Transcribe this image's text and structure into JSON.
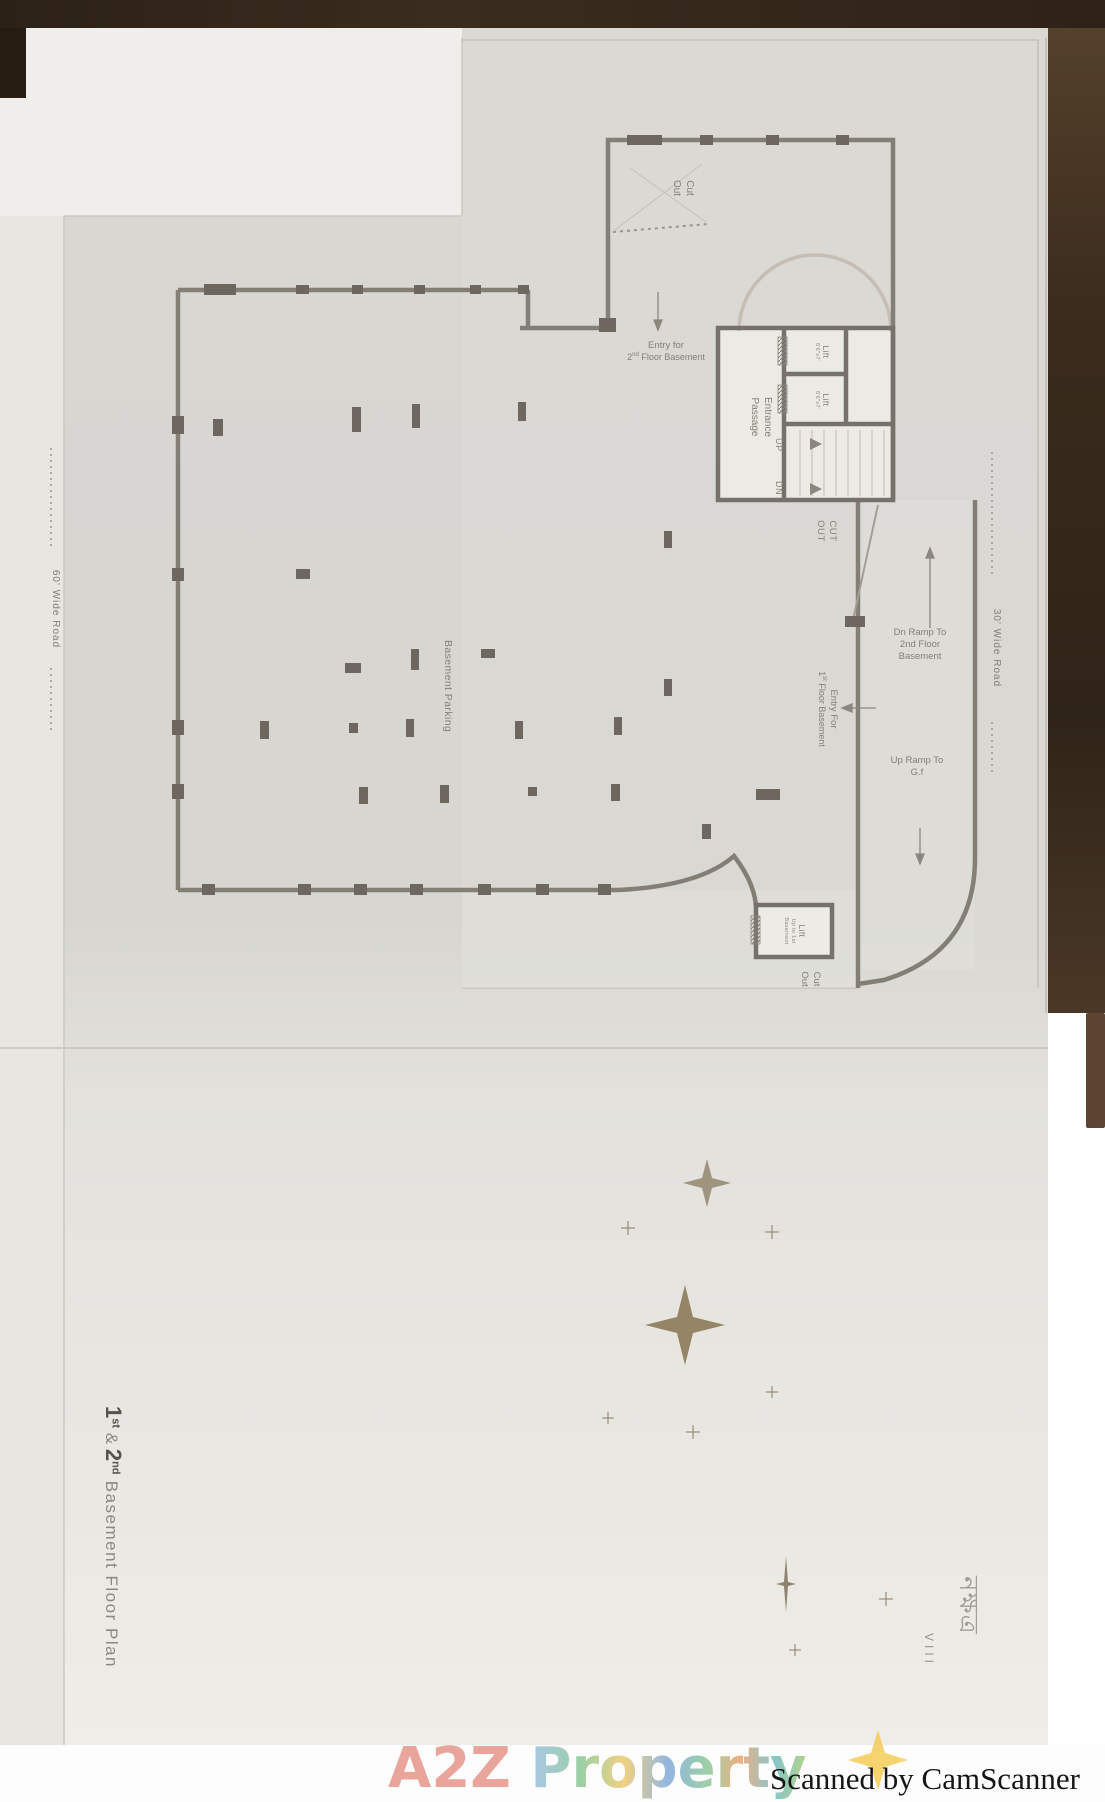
{
  "scan": {
    "camscanner": "Scanned by CamScanner",
    "watermark_a2z": "A2Z",
    "watermark_property": "Property"
  },
  "footer_title": {
    "n1": "1",
    "s1": "st",
    "mid": " & ",
    "n2": "2",
    "s2": "nd",
    "rest": " Basement Floor Plan"
  },
  "logo": {
    "brand": "নক্ষত্র",
    "series": "VIII"
  },
  "roads": {
    "right": "30' Wide Road",
    "left": "60' Wide Road"
  },
  "plan": {
    "cut_out_l1": "Cut",
    "cut_out_l2": "Out",
    "entry2_line1": "Entry for",
    "entry2_n": "2",
    "entry2_sup": "nd",
    "entry2_rest": " Floor Basement",
    "entrance_line1": "Entrance",
    "entrance_line2": "Passage",
    "lift": "Lift",
    "lift_dim": "6'6\"x7'",
    "up": "UP",
    "dn": "DN",
    "cutout_l1": "CUT",
    "cutout_l2": "OUT",
    "parking": "Basement Parking",
    "entry1_line1": "Entry For",
    "entry1_n": "1",
    "entry1_sup": "st",
    "entry1_rest": " Floor Basement",
    "dnramp_l1": "Dn Ramp To",
    "dnramp_l2": "2nd Floor",
    "dnramp_l3": "Basement",
    "upramp_l1": "Up Ramp To",
    "upramp_l2": "G.f",
    "lift_b": "Lift",
    "lift_b_note1": "Up to 1st",
    "lift_b_note2": "Basement",
    "cutout_b_l1": "Cut",
    "cutout_b_l2": "Out"
  }
}
